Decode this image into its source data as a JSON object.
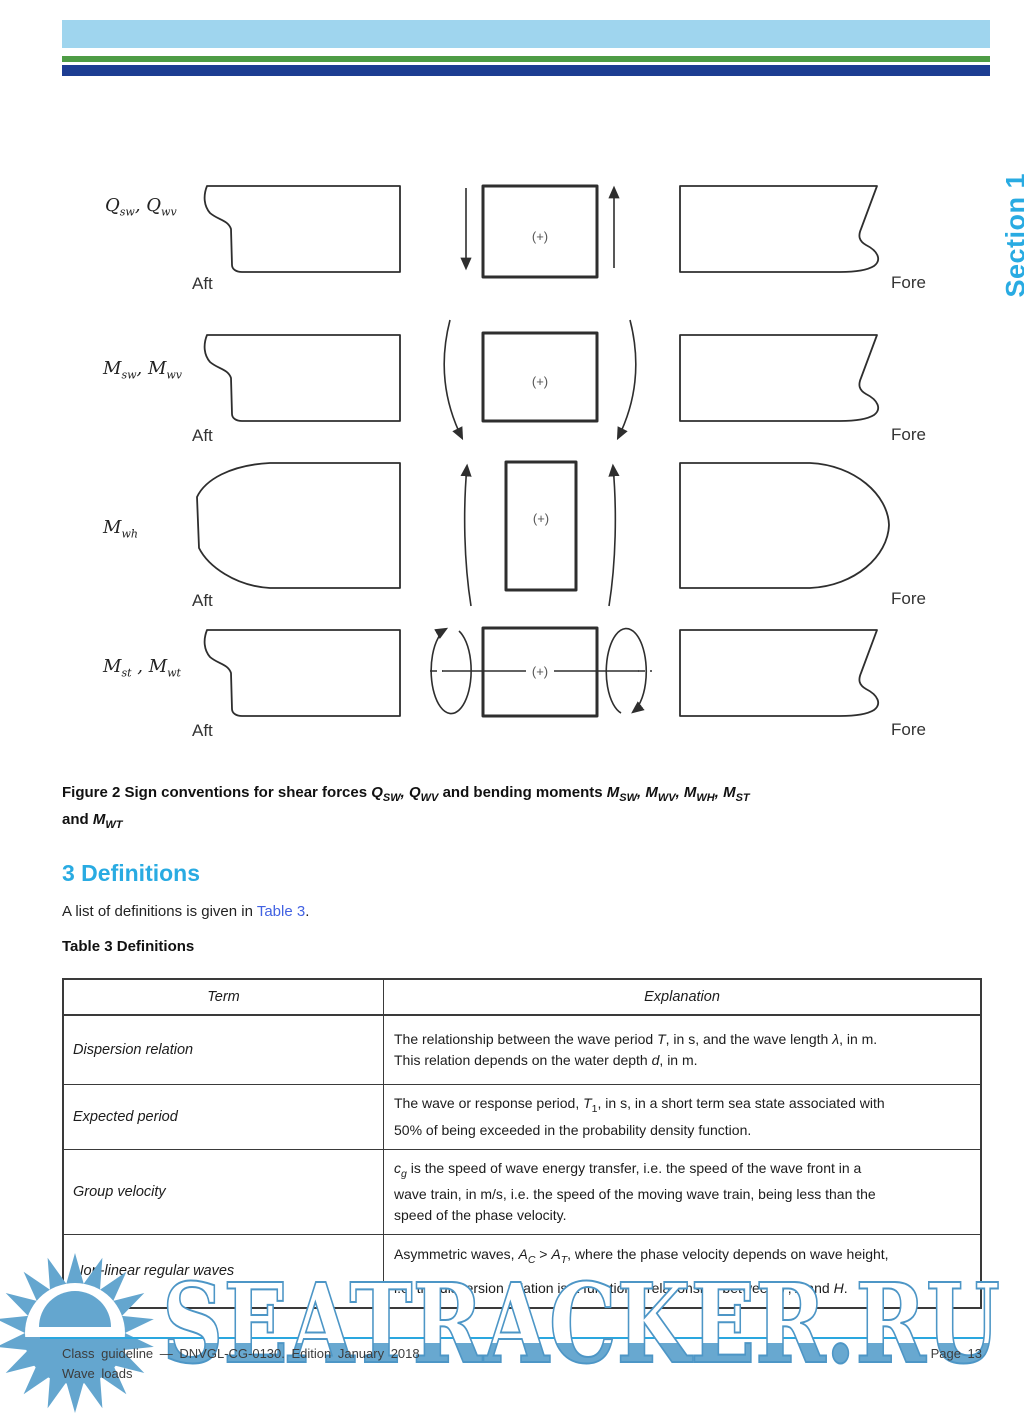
{
  "colors": {
    "bar-lightblue": "#9FD5EE",
    "bar-green": "#4E9C45",
    "bar-navy": "#1D3D92",
    "accent-cyan": "#29ABE2",
    "link-blue": "#4262E2",
    "wm-blue": "#64A6CF",
    "wm-outline": "#4D96C6",
    "wm-line": "#2AA7DF"
  },
  "section_tab": "Section 1",
  "figure": {
    "rows": [
      {
        "label_html": "<i>Q</i><sub>sw</sub>, <i>Q</i><sub>wv</sub>"
      },
      {
        "label_html": "<i>M</i><sub>sw</sub>, <i>M</i><sub>wv</sub>"
      },
      {
        "label_html": "<i>M</i><sub>wh</sub>"
      },
      {
        "label_html": "<i>M</i><sub>st</sub> , <i>M</i><sub>wt</sub>"
      }
    ],
    "aft_label": "Aft",
    "fore_label": "Fore",
    "plus_label": "(+)",
    "caption_html": "Figure 2 Sign conventions for shear forces <i>Q<sub>SW</sub>, Q<sub>WV</sub></i> and bending moments <i>M<sub>SW</sub>, M<sub>WV</sub>, M<sub>WH</sub>, M<sub>ST</sub></i><br>and <i>M<sub>WT</sub></i>"
  },
  "definitions": {
    "heading": "3 Definitions",
    "intro_prefix": "A list of definitions is given in ",
    "intro_link": "Table 3",
    "intro_suffix": ".",
    "table_title": "Table 3 Definitions",
    "table": {
      "headers": [
        "Term",
        "Explanation"
      ],
      "rows": [
        {
          "term": "Dispersion relation",
          "explanation_html": "The relationship between the wave period <i>T</i>, in s, and the wave length <i>λ</i>, in m.<br>This relation depends on the water depth <i>d</i>, in m."
        },
        {
          "term": "Expected period",
          "explanation_html": "The wave or response period, <i>T</i><sub>1</sub>, in s, in a short term sea state associated with<br>50% of being exceeded in the probability density function."
        },
        {
          "term": "Group velocity",
          "explanation_html": "<i>c<sub>g</sub></i> is the speed of wave energy transfer, i.e. the speed of the wave front in a<br>wave train, in m/s, i.e. the speed of the moving wave train, being less than the<br>speed of the phase velocity."
        },
        {
          "term": "Non-linear regular waves",
          "explanation_html": "Asymmetric waves, <i>A<sub>C</sub></i> &gt; <i>A<sub>T</sub></i>, where the phase velocity depends on wave height,<br>i.e. the dispersion relation is a functional relationship between <i>T</i>, <i>λ</i> and <i>H</i>."
        }
      ]
    }
  },
  "footer": {
    "line1": "Class guideline — DNVGL-CG-0130. Edition January 2018",
    "line2": "Wave loads",
    "page": "Page 13"
  },
  "watermark": {
    "text": "SEATRACKER.RU"
  }
}
